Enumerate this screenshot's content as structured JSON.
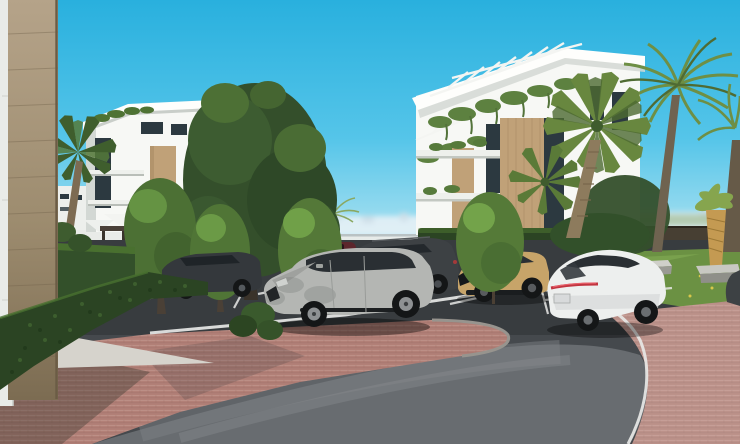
{
  "scene": {
    "setting": "Modern white apartment complex with parking area, palm trees and a curved road",
    "buildings": {
      "left": "white-modern-apartment-block",
      "right": "white-modern-apartment-with-roof-pergola-and-wood-cladding"
    },
    "vehicles": [
      {
        "name": "dark-gray-sedan",
        "color": "#34383c"
      },
      {
        "name": "maroon-car",
        "color": "#5c262c"
      },
      {
        "name": "dark-gray-suv",
        "color": "#3d4144"
      },
      {
        "name": "silver-suv",
        "color": "#b4b6b3"
      },
      {
        "name": "tan-compact-suv",
        "color": "#c7a469"
      },
      {
        "name": "white-sedan",
        "color": "#edefee"
      },
      {
        "name": "partial-dark-car",
        "color": "#26292c"
      }
    ],
    "vegetation": [
      "boxwood-hedges",
      "deciduous-trees",
      "fan-palms",
      "feather-palms",
      "golden-trunk-palm",
      "lawns",
      "hanging-balcony-plants"
    ],
    "ground": [
      "red-brick-pavement",
      "dark-asphalt-parking",
      "curved-asphalt-road",
      "white-road-markings",
      "gravel-strip"
    ],
    "furniture": [
      "white-parasols",
      "sun-loungers",
      "concrete-benches",
      "dark-pergola-bar",
      "dark-fence"
    ]
  },
  "colors": {
    "sky_top": "#29b0de",
    "sky_mid": "#55c5e9",
    "sky_horizon": "#b6e5f2",
    "skyline": "#e6f1f6",
    "white_building": "#f7f8f5",
    "parapet": "#fefefc",
    "building_shade": "#d3d8d4",
    "window_dark": "#2c3940",
    "wood_cladding": "#c0a178",
    "travertine_light": "#b5a389",
    "travertine_mid": "#9d8c6f",
    "travertine_dark": "#7c6c52",
    "white_wall": "#e9ebe8",
    "hedge_dark": "#2b4423",
    "hedge_mid": "#33502a",
    "hedge_light": "#49702f",
    "tree_dark": "#344f2b",
    "tree_mid": "#4c7034",
    "tree_bright": "#6b9a46",
    "palm_green": "#68873f",
    "palm_dark": "#4d6a32",
    "palm_feather": "#6e8f45",
    "trunk_brown": "#6f6350",
    "golden_trunk": "#c49a52",
    "grass_left": "#58793b",
    "grass_right": "#6b9143",
    "asphalt_dark": "#383c3f",
    "asphalt_base": "#45494d",
    "road_light": "#686c70",
    "line_white": "#e7e8e6",
    "curb_gray": "#97948e",
    "brick": "#b28077",
    "gravel": "#d6d3cc",
    "fence_dark": "#473f33",
    "car_silver": "#b4b6b3",
    "car_white": "#edefee",
    "car_tan": "#c7a469",
    "car_dark_suv": "#3d4144",
    "car_dark_sedan": "#34383c",
    "car_maroon": "#5c262c",
    "taillight_red": "#c23540",
    "glass_dark": "#2a2f33",
    "tire_black": "#141617",
    "parasol_white": "#f3f4f1"
  }
}
